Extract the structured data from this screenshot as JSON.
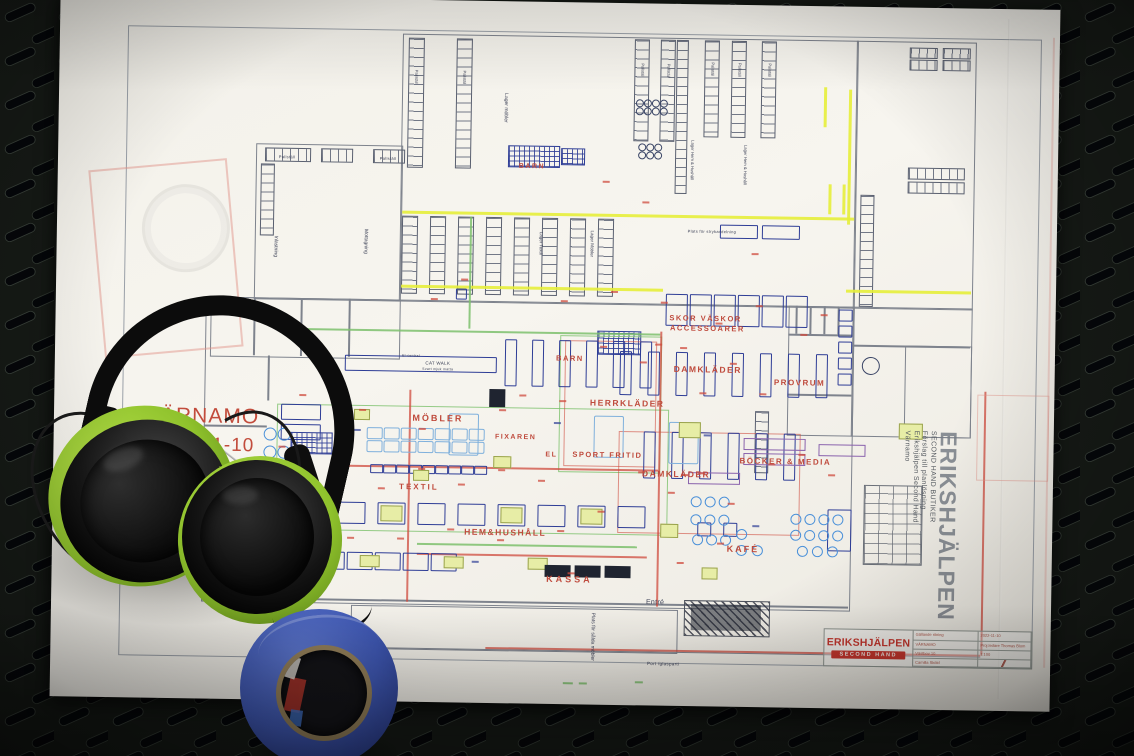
{
  "annotations_left": {
    "city": "VÄRNAMO",
    "date": "2022-11-10",
    "area": "yta: 990 m2"
  },
  "plan_labels": {
    "barn_warehouse": "BARN",
    "barn_store": "BARN",
    "mobler": "MÖBLER",
    "textil": "TEXTIL",
    "hem_hushall": "HEM&HUSHÅLL",
    "belysning": "BELYSNING",
    "fixaren": "FIXAREN",
    "el": "EL",
    "sport_fritid": "SPORT FRITID",
    "herrklader": "HERRKLÄDER",
    "damklader_upper": "DAMKLÄDER",
    "damklader_lower": "DAMKLÄDER",
    "skor_line1": "SKOR VÄSKOR",
    "skor_line2": "ACCESSOARER",
    "provrum": "PROVRUM",
    "bocker_media": "BÖCKER & MEDIA",
    "kafe": "KAFÉ",
    "kassa": "KASSA",
    "entre": "Entré",
    "catwalk_line1": "CAT WALK",
    "catwalk_line2": "Svart mjuk matta",
    "plats_stryk": "Plats för strykavdelning",
    "plats_salda": "Plats för sålda möbler",
    "port": "Port /glasparti",
    "el_central": "El-central",
    "inlastning": "Inlastning",
    "mottagning": "Mottagning",
    "lager_mobler": "Lager möbler",
    "lager_textil": "Lager Textil",
    "lager_mobler2": "Lager Möbler",
    "lager_hem1": "Lager Hem & Hushåll",
    "lager_hem2": "Lager Hem & Hushåll",
    "pallstall": "Pallställ"
  },
  "title_block": {
    "brand_line1": "ERIKSHJÄLPEN",
    "brand_line2": "SECOND HAND",
    "field1": "Gällande ritning",
    "date": "2022-11-10",
    "city": "VÄRNAMO",
    "manager": "Proj.ledare Thomas Blom",
    "address": "Västbov 10",
    "scale": "1:100",
    "author": "Camilla Sköld"
  },
  "side_text": {
    "brand": "ERIKSHJÄLPEN",
    "line1": "SECOND HAND BUTIKER",
    "line2": "Förslag till planlösning",
    "line3": "Erikshjälpen Second Hand",
    "line4": "Värnamo"
  },
  "colors": {
    "plan_red": "#bf4a3c",
    "plan_navy": "#2e3d96",
    "plan_lightblue": "#7fb0dc",
    "plan_green": "#7cc06c",
    "plan_yellow": "#e6ee3a",
    "logo_red": "#c8372e",
    "tape_blue": "#3f58b4",
    "earmuff_green": "#8fc22c"
  }
}
